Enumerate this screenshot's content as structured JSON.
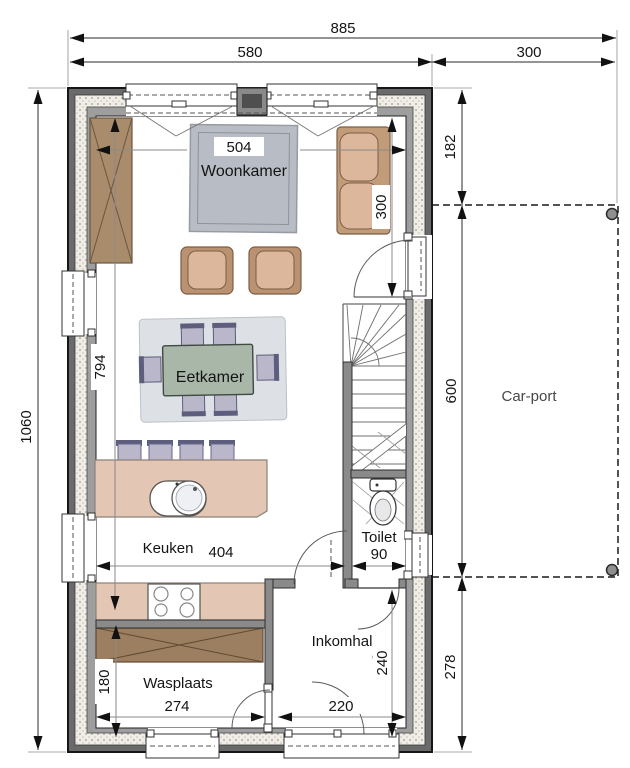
{
  "plan": {
    "labels": {
      "woonkamer": "Woonkamer",
      "eetkamer": "Eetkamer",
      "keuken": "Keuken",
      "toilet": "Toilet",
      "inkomhal": "Inkomhal",
      "wasplaats": "Wasplaats",
      "carport": "Car-port"
    },
    "dims": {
      "total_width": "885",
      "house_width": "580",
      "carport_width": "300",
      "total_depth": "1060",
      "right_top": "182",
      "carport_depth": "600",
      "right_bottom": "278",
      "living_width": "504",
      "sofa_wall": "300",
      "interior_depth": "794",
      "kitchen_width": "404",
      "toilet_width": "90",
      "hall_depth": "240",
      "hall_width": "220",
      "laundry_width": "274",
      "laundry_cabinet": "180"
    },
    "colors": {
      "wall": "#6a6a6a",
      "wall_inner": "#9e9e9e",
      "wood": "#a98c6c",
      "wood_dark": "#9c7e60",
      "upholstery": "#dcb79c",
      "upholstery_frame": "#bb9271",
      "rug": "#b8bcc4",
      "rug_light": "#dde0e4",
      "table": "#a9b7a9",
      "chair": "#b9b7c9",
      "chair_accent": "#5d5e7d",
      "counter": "#e3c7b4",
      "dim_line": "#1a1a1a"
    }
  }
}
